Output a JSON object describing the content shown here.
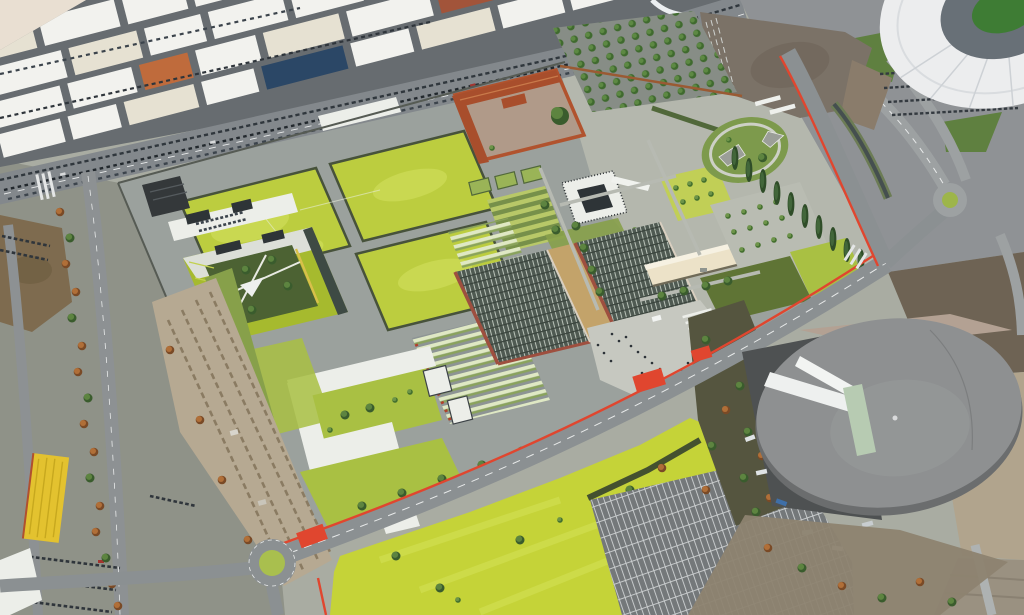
{
  "scene": {
    "type": "aerial-architectural-rendering",
    "description": "Bird's-eye masterplan rendering: campus with four chartreuse sports fields, green-roof courtyard block, historic walled farmstead with orange walls, tree orchard, circular lawn park, skylight-roofed halls, long cream canopy, pedestrian plaza with red crosswalks, roundabout, bright yellow meadow, striped car park, round grey arena, white stadium at top right, industrial warehouse district at top left, tree-lined boulevards and a rubble demolition strip at left",
    "landmarks": [
      {
        "id": "stadium",
        "label": "white stadium"
      },
      {
        "id": "arena",
        "label": "round grey arena"
      },
      {
        "id": "industrial-district",
        "label": "warehouse district"
      },
      {
        "id": "sports-fields",
        "label": "chartreuse sports fields"
      },
      {
        "id": "farmstead",
        "label": "walled farmstead"
      },
      {
        "id": "orchard",
        "label": "tree orchard"
      },
      {
        "id": "circular-park",
        "label": "circular lawn park"
      },
      {
        "id": "museum-block",
        "label": "white courtyard building"
      },
      {
        "id": "skylight-halls",
        "label": "skylight-roofed halls"
      },
      {
        "id": "canopy",
        "label": "long cream canopy"
      },
      {
        "id": "plaza",
        "label": "pedestrian plaza"
      },
      {
        "id": "green-roof-block",
        "label": "green-roof courtyard block"
      },
      {
        "id": "u-block",
        "label": "white U-shaped building"
      },
      {
        "id": "meadow",
        "label": "yellow meadow"
      },
      {
        "id": "car-park",
        "label": "striped car park"
      },
      {
        "id": "roundabout",
        "label": "roundabout"
      },
      {
        "id": "rubble-strip",
        "label": "demolition strip"
      },
      {
        "id": "yellow-shed",
        "label": "yellow shed"
      },
      {
        "id": "esplanade",
        "label": "brown esplanade"
      },
      {
        "id": "poplar-row",
        "label": "poplar row"
      }
    ]
  },
  "colors": {
    "base": "#a9aca2",
    "industrial_street": "#676c70",
    "warehouse_roof": "#f2f2ee",
    "road": "#8b9092",
    "red_accent": "#e0462f",
    "campus_paving": "#9ba19d",
    "park_paving": "#b4b7ad",
    "field": "#bccd3f",
    "hedge": "#47523b",
    "lawn_olive": "#87a04a",
    "lawn_bright": "#a9c043",
    "meadow": "#c5d338",
    "green_roof": "#a6ba2e",
    "courtyard_garden": "#4c6233",
    "cascina_wall": "#b1532e",
    "cascina_roof": "#a84e2c",
    "cascina_court": "#b09a89",
    "white_building": "#eceee9",
    "glass_dark": "#2e3437",
    "barrack_roof": "#4f5a52",
    "barrack_wall": "#9e4f3f",
    "canopy_cream": "#ece2c8",
    "esplanade": "#7b7267",
    "dirt_brown": "#7e6b4f",
    "rubble": "#b6a992",
    "arena_gray": "#8e9091",
    "arena_dark": "#6b6d6e",
    "stadium_roof": "#ecedee",
    "stands": "#687077",
    "pitch": "#3e7c34",
    "parking_asphalt": "#74787a",
    "plaza": "#c6c8c0",
    "yellow_shed": "#e3c22f",
    "brown_field": "#6e6354",
    "pale_dirt": "#b1a48d",
    "water_dark": "#454f4f",
    "roundabout_green": "#a9bf4e",
    "corner_blank": "#e9dfd2"
  }
}
